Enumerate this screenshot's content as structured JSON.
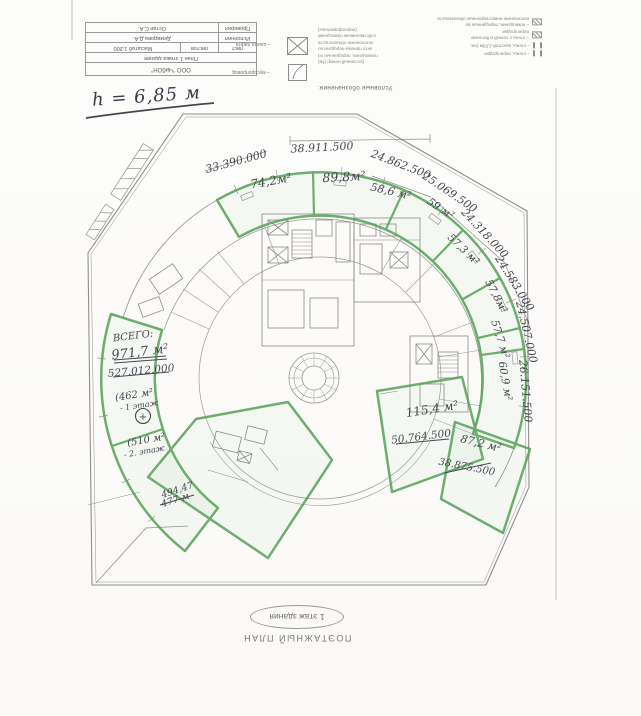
{
  "sheet": {
    "height_note": "h = 6,85 м"
  },
  "title_block": {
    "company": "ООО \"ЧибОН\"",
    "doc_title": "План 1 этажа здания",
    "sheet_label": "лист",
    "sheets_label": "листов",
    "scale": "Масштаб 1:200",
    "performed_label": "Исполнил",
    "performed_name": "Демидова Д.А.",
    "checked_label": "Проверил",
    "checked_name": "Остап С.А."
  },
  "legend": {
    "heading": "Условные обозначения:",
    "elevator_label": "– шахта лифта",
    "chute_label": "– мусоропровод",
    "note_lines": [
      "(условный номер (№)",
      "помещения, переданные по",
      "акту приема-передачи во",
      "исполнение обязательств",
      "собственникам помещений",
      "(переоформлены)"
    ],
    "wall_label": "– стены, перегородки",
    "wall_h_label": "– стены, высотой 2,53м (см.",
    "mesh_label_1": "– стена с сеткой и бетоном",
    "mesh_label_2": "перегородки",
    "invest_label_1": "– помещения, переданные во",
    "invest_label_2": "исполнение инвестиционных обязательств"
  },
  "plan": {
    "rooms": [
      {
        "area": "74,2м²",
        "price": "33.390.000"
      },
      {
        "area": "89,8м²",
        "price": "38.911.500"
      },
      {
        "area": "58,6 м²",
        "price": "24.862.500"
      },
      {
        "area": "59 м²",
        "price": "25.069.500"
      },
      {
        "area": "57,3 м²",
        "price": "24.318.000"
      },
      {
        "area": "57,8м²",
        "price": "24.583.000"
      },
      {
        "area": "57,7 м²",
        "price": "24.507.000"
      },
      {
        "area": "60,9 м²",
        "price": "26.151.500"
      },
      {
        "area": "115,4 м²",
        "price": "50.764.500"
      },
      {
        "area": "87,2 м²",
        "price": "38.875.500"
      }
    ],
    "total": {
      "label": "ВСЕГО:",
      "area": "971,7 м²",
      "price": "527.012.000",
      "floor1": "(462 м²",
      "floor1b": "- 1 этаж",
      "floor2": "(510 м²",
      "floor2b": "- 2. этаж",
      "sum1": "494,47",
      "sum2": "477 м",
      "plus": "+"
    }
  },
  "footer": {
    "floor_badge": "1 этаж здания",
    "plan_label": "ПОЭТАЖНЫЙ ПЛАН"
  }
}
